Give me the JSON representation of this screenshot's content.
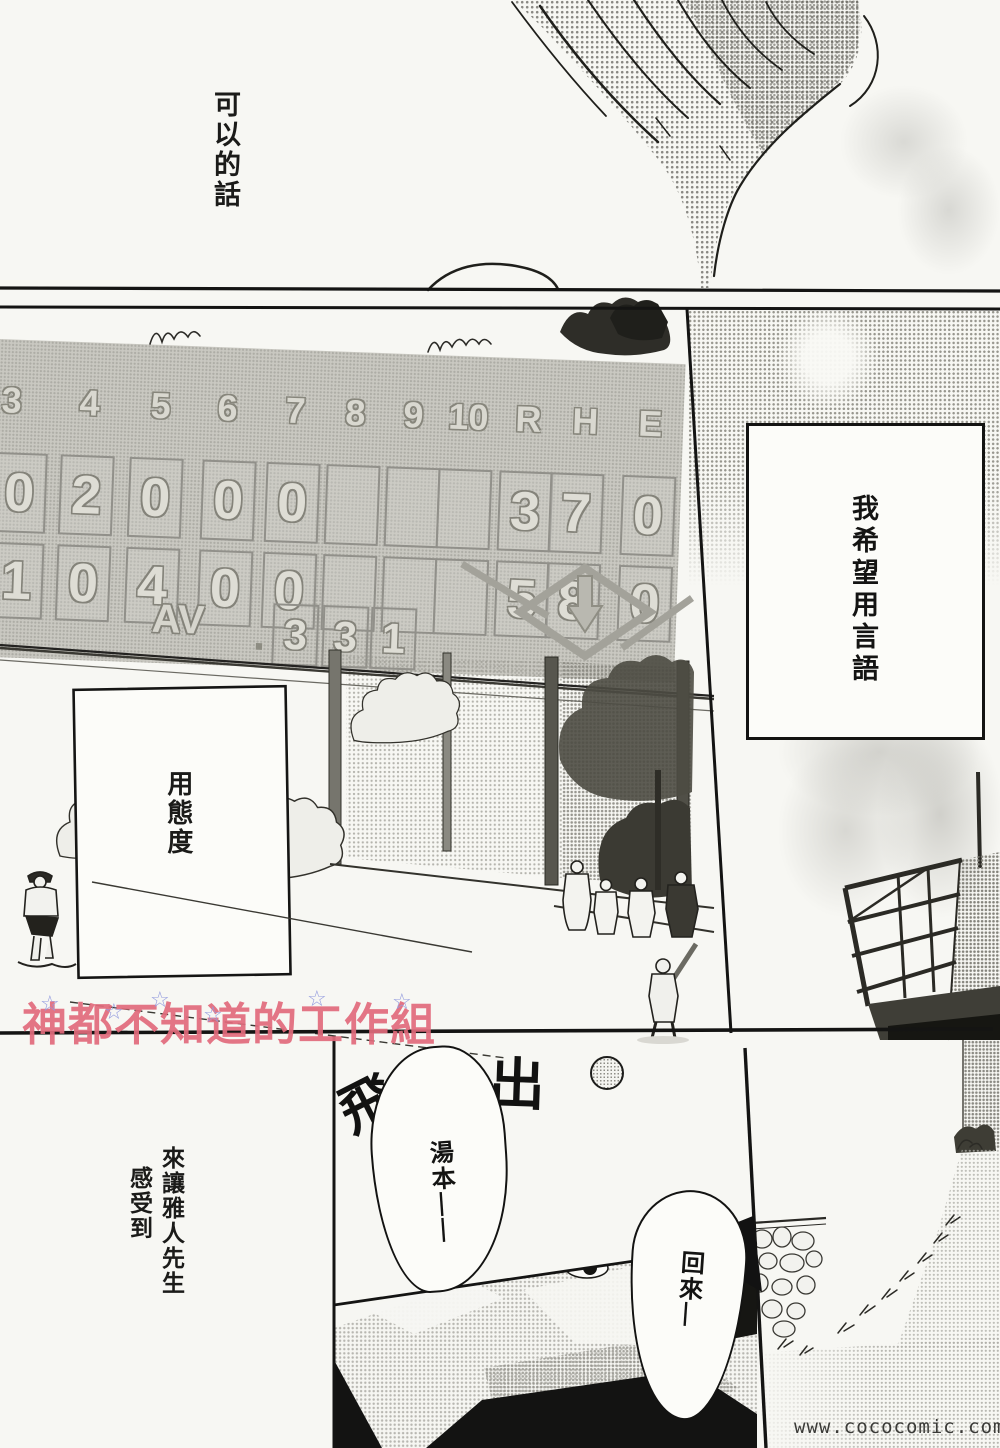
{
  "watermark": {
    "group_name": "神都不知道的工作組",
    "star": "☆",
    "site_url": "www.cococomic.com"
  },
  "narration": {
    "top_right_panel": "可以的話",
    "sky_box": "我希望用言語",
    "field_box": "用態度",
    "left_margin_line1": "來讓雅人先生",
    "left_margin_line2": "感受到"
  },
  "sfx": {
    "fly": "飛",
    "out": "出"
  },
  "speech": {
    "yumoto_call": "湯本——",
    "comeback_call": "回來—"
  },
  "scoreboard": {
    "header": [
      "3",
      "4",
      "5",
      "6",
      "7",
      "8",
      "9",
      "10",
      "R",
      "H",
      "E"
    ],
    "row_top": [
      "0",
      "2",
      "0",
      "0",
      "0",
      "",
      "",
      "",
      "3",
      "7",
      "0"
    ],
    "row_bottom": [
      "1",
      "0",
      "4",
      "0",
      "0",
      "",
      "",
      "",
      "5",
      "8",
      "0"
    ],
    "avg_label": "AV",
    "avg_dot": ".",
    "avg_digits": [
      "3",
      "3",
      "1"
    ]
  }
}
